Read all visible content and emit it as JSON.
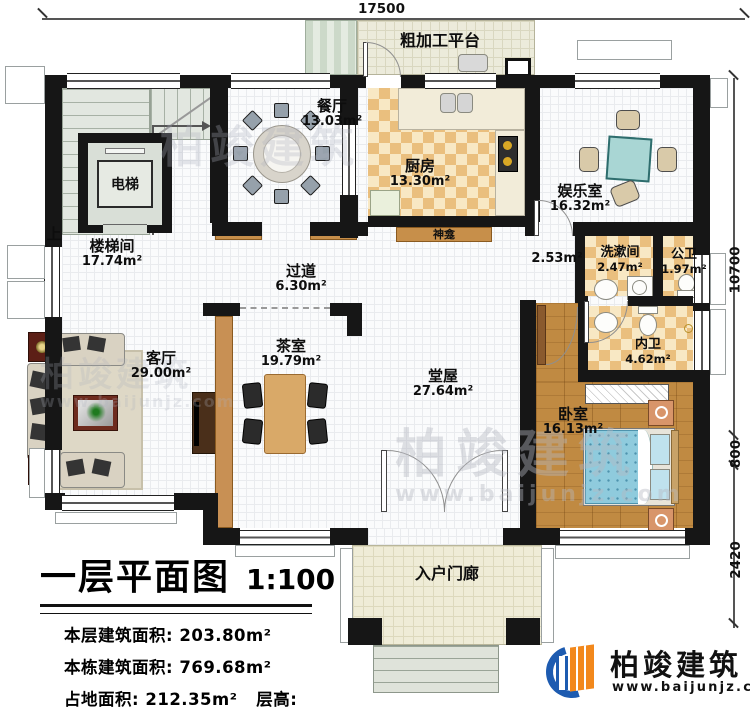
{
  "plan": {
    "title": "一层平面图",
    "scale": "1:100",
    "dims": {
      "top": "17500",
      "right_main": "10700",
      "right_mid": "800",
      "right_low": "2420"
    },
    "rooms": {
      "stairwell": {
        "name": "楼梯间",
        "area": "17.74m²"
      },
      "elevator": {
        "name": "电梯"
      },
      "up_mark": {
        "name": "上"
      },
      "dining": {
        "name": "餐厅",
        "area": "13.03m²"
      },
      "kitchen": {
        "name": "厨房",
        "area": "13.30m²"
      },
      "platform": {
        "name": "粗加工平台"
      },
      "entertainment": {
        "name": "娱乐室",
        "area": "16.32m²"
      },
      "hallway": {
        "name": "过道",
        "area": "6.30m²"
      },
      "niche_corridor": {
        "area": "2.53m²"
      },
      "washroom": {
        "name": "洗漱间",
        "area": "2.47m²"
      },
      "public_bath": {
        "name": "公卫",
        "area": "1.97m²"
      },
      "inner_bath": {
        "name": "内卫",
        "area": "4.62m²"
      },
      "shrine": {
        "name": "神龛"
      },
      "tea_room": {
        "name": "茶室",
        "area": "19.79m²"
      },
      "living": {
        "name": "客厅",
        "area": "29.00m²"
      },
      "hall": {
        "name": "堂屋",
        "area": "27.64m²"
      },
      "bedroom": {
        "name": "卧室",
        "area": "16.13m²"
      },
      "porch": {
        "name": "入户门廊"
      }
    },
    "info": {
      "line1_label": "本层建筑面积:",
      "line1_value": "203.80m²",
      "line2_label": "本栋建筑面积:",
      "line2_value": "769.68m²",
      "line3_label": "占地面积:",
      "line3_value": "212.35m²",
      "line4_label": "层高:",
      "line4_value": "3.9m"
    },
    "logo": {
      "company": "柏竣建筑",
      "website": "www.baijunjz.com"
    },
    "watermark": {
      "text": "柏竣建筑",
      "url": "www.baijunjz.com"
    },
    "colors": {
      "wall": "#161616",
      "logo_blue": "#1d5bb0",
      "logo_orange": "#f2881c",
      "wood_floor": "#c08a42",
      "checker_tile": "#eabf7e",
      "bed_teal": "#8fcbdd",
      "mahjong_teal": "#a9d6d4",
      "cabinet_brown": "#c78f4a"
    }
  }
}
